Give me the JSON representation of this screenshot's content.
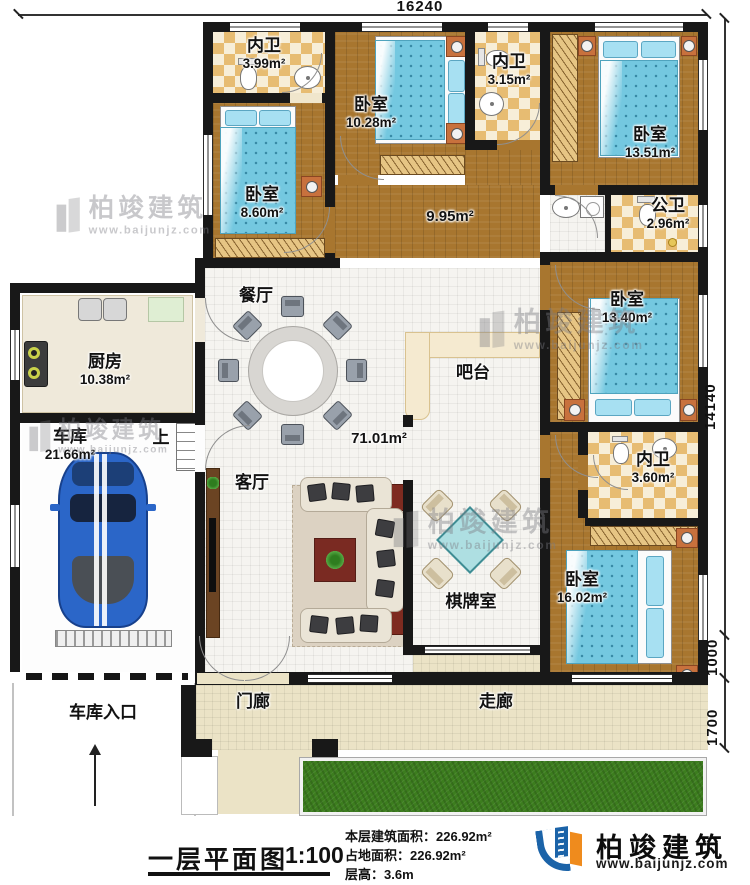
{
  "plan": {
    "dim_top": "16240",
    "dim_right_main": "14140",
    "dim_right_mid": "1000",
    "dim_right_bottom": "1700"
  },
  "rooms": {
    "bath_399": {
      "name": "内卫",
      "area": "3.99m²"
    },
    "bed_1028": {
      "name": "卧室",
      "area": "10.28m²"
    },
    "bath_315": {
      "name": "内卫",
      "area": "3.15m²"
    },
    "bed_1351": {
      "name": "卧室",
      "area": "13.51m²"
    },
    "bed_860": {
      "name": "卧室",
      "area": "8.60m²"
    },
    "pub_bath": {
      "name": "公卫",
      "area": "2.96m²"
    },
    "hall": {
      "area": "9.95m²"
    },
    "bed_1340": {
      "name": "卧室",
      "area": "13.40m²"
    },
    "kitchen": {
      "name": "厨房",
      "area": "10.38m²"
    },
    "dining": {
      "name": "餐厅"
    },
    "bar": {
      "name": "吧台"
    },
    "great_room": {
      "area": "71.01m²"
    },
    "living": {
      "name": "客厅"
    },
    "garage": {
      "name": "车库",
      "area": "21.66m²"
    },
    "stairs": {
      "name": "上"
    },
    "bath_360": {
      "name": "内卫",
      "area": "3.60m²"
    },
    "bed_1602": {
      "name": "卧室",
      "area": "16.02m²"
    },
    "chess": {
      "name": "棋牌室"
    },
    "porch": {
      "name": "门廊"
    },
    "corridor": {
      "name": "走廊"
    },
    "garage_entry": {
      "name": "车库入口"
    }
  },
  "title_block": {
    "plan_title": "一层平面图",
    "scale": "1:100",
    "stat1_label": "本层建筑面积：",
    "stat1_value": "226.92m²",
    "stat2_label": "占地面积：",
    "stat2_value": "226.92m²",
    "stat3_label": "层高：",
    "stat3_value": "3.6m"
  },
  "brand": {
    "name": "柏竣建筑",
    "website": "www.baijunjz.com"
  },
  "watermark": {
    "name": "柏竣建筑",
    "website": "www.baijunjz.com"
  }
}
